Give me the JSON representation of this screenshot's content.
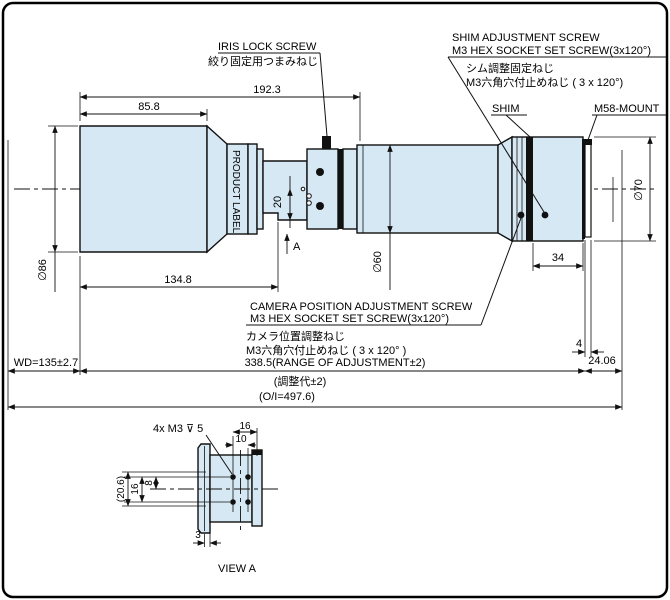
{
  "drawing": {
    "title": "VIEW A",
    "colors": {
      "body_fill": "#d6e8f4",
      "line": "#111111",
      "background": "#ffffff"
    },
    "labels": {
      "iris_en": "IRIS LOCK SCREW",
      "iris_jp": "絞り固定用つまみねじ",
      "shim_en1": "SHIM ADJUSTMENT SCREW",
      "shim_en2": "M3 HEX SOCKET SET SCREW(3x120°)",
      "shim_jp1": "シム調整固定ねじ",
      "shim_jp2": "M3六角穴付止めねじ ( 3 x 120°)",
      "shim": "SHIM",
      "mount": "M58-MOUNT",
      "camera_en1": "CAMERA POSITION ADJUSTMENT SCREW",
      "camera_en2": "M3 HEX SOCKET SET SCREW(3x120°)",
      "camera_jp1": "カメラ位置調整ねじ",
      "camera_jp2": "M3六角穴付止めねじ ( 3 x 120° )",
      "product_label": "PRODUCT LABEL",
      "view_arrow": "A",
      "view_title": "VIEW A",
      "thread_callout": "4x M3 ⊽ 5"
    },
    "dims": {
      "d192_3": "192.3",
      "d85_8": "85.8",
      "dia86": "∅86",
      "d134_8": "134.8",
      "d20": "20",
      "dia60": "∅60",
      "d34": "34",
      "dia70": "∅70",
      "d4": "4",
      "d24_06": "24.06",
      "wd": "WD=135±2.7",
      "range_en": "338.5(RANGE OF ADJUSTMENT±2)",
      "range_jp": "(調整代±2)",
      "oi": "(O/I=497.6)",
      "va16_top": "16",
      "va10": "10",
      "va20_6": "(20.6)",
      "va16_left": "16",
      "va8": "8",
      "va3": "3"
    }
  }
}
